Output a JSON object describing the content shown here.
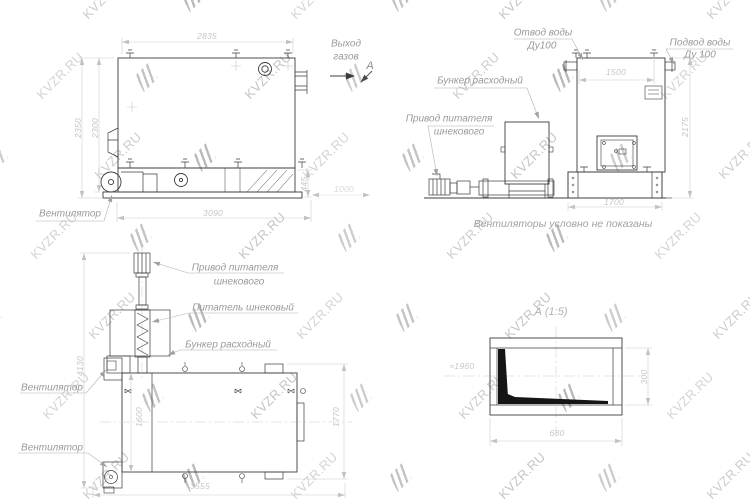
{
  "drawing": {
    "watermark": {
      "text": "KVZR.RU"
    },
    "colors": {
      "line": "#3c3c3c",
      "dimension": "#c6c6c6",
      "label": "#9a9a9a",
      "watermark": "#bdbdbd"
    },
    "side_view": {
      "labels": {
        "fan": "Вентилятор",
        "gas_outlet_1": "Выход",
        "gas_outlet_2": "газов",
        "section_mark": "А"
      },
      "dims": {
        "top_width": "2835",
        "height_outer": "2350",
        "height_inner": "2300",
        "base_length": "3090",
        "conveyor_height": "445",
        "right_offset": "1000"
      }
    },
    "front_view": {
      "labels": {
        "water_outlet_1": "Отвод воды",
        "water_outlet_2": "Ду100",
        "water_inlet_1": "Подвод воды",
        "water_inlet_2": "Ду 100",
        "hopper": "Бункер расходный",
        "drive_1": "Привод питателя",
        "drive_2": "шнекового"
      },
      "dims": {
        "top_width": "1500",
        "height": "2175",
        "conveyor_length": "1700"
      },
      "note": "Вентиляторы условно не показаны"
    },
    "plan_view": {
      "labels": {
        "drive_1": "Привод питателя",
        "drive_2": "шнекового",
        "screw_feeder": "Питатель шнековый",
        "hopper": "Бункер расходный",
        "fan_middle": "Вентилятор",
        "fan_bottom": "Вентилятор"
      },
      "dims": {
        "total_depth": "4130",
        "boiler_width": "1600",
        "right_width": "1770",
        "total_length": "3555"
      }
    },
    "detail_view": {
      "title": "А (1:5)",
      "dims": {
        "reference": "≈1960",
        "height": "300",
        "length": "680"
      }
    }
  }
}
